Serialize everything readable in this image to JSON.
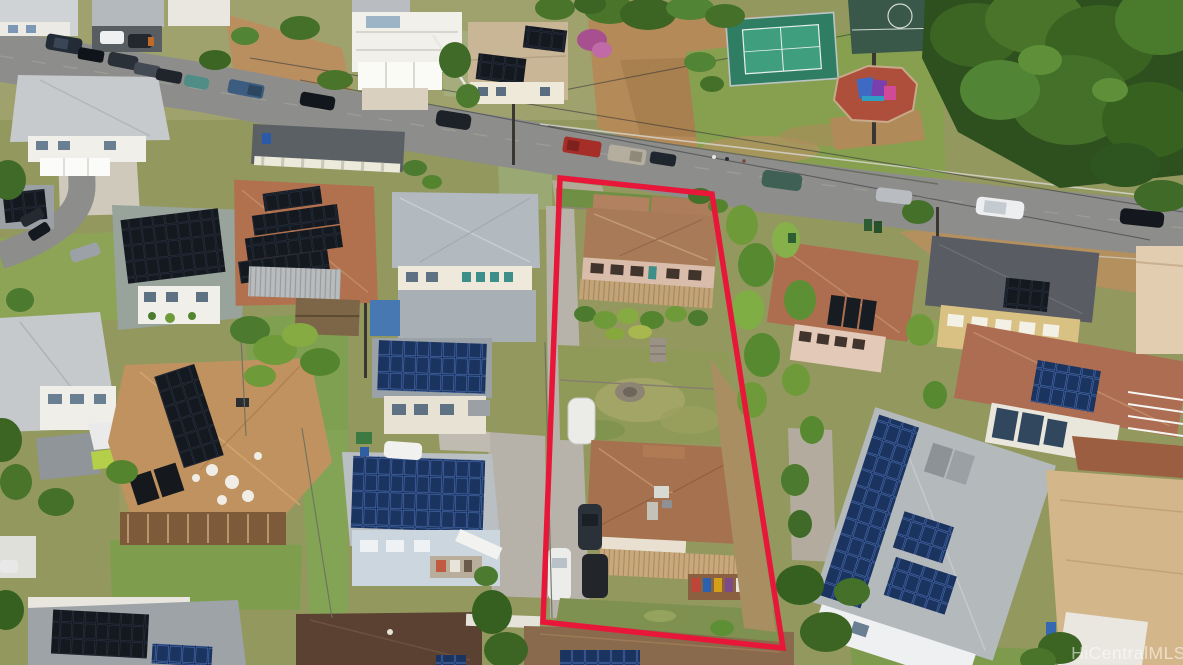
{
  "meta": {
    "title": "Aerial drone photograph of a residential hillside neighborhood",
    "style": "top-down oblique aerial real-estate photo, daytime, sunny",
    "region_hint": "tropical suburb with many rooftop solar installations"
  },
  "watermark": {
    "text": "HiCentralMLS",
    "color": "#ffffff",
    "opacity": "0.55"
  },
  "property_outline": {
    "description": "red boundary drawn around the deep flag-shaped subject lot in the center",
    "color": "#e8173a",
    "stroke_width": "5.5",
    "points": "560,178 712,194 783,648 543,622"
  },
  "subject_lot": {
    "front_house": "two-story tan house with brown hip roof, corrugated awning and tropical garden",
    "rear_house": "single-story house with brown hip roof and long carport awning",
    "yard": "patchy green lawn with rock terracing and stone mound",
    "driveway": "concrete strip along the left boundary",
    "vehicles": [
      "covered white vehicle",
      "white sedan",
      "dark sedan",
      "dark sedan"
    ]
  },
  "park": {
    "features": [
      "fenced tennis court",
      "basketball court",
      "playground with red surface",
      "grass field",
      "walking path with pedestrians"
    ],
    "tennis_court_color": "#3f9e7d",
    "basketball_court_color": "#39584a",
    "playground_surface_color": "#ad4f3a"
  },
  "roads": {
    "main_road": "two-lane street running diagonally from upper-left to the right edge, lined with parked cars",
    "side_street": "narrow lane curving down the left edge of the frame",
    "surface_color": "#8d8d8b"
  },
  "parked_vehicles_main_road": [
    "dark SUV",
    "black sedan",
    "dark SUV",
    "gray sedan",
    "dark sedan",
    "teal hatchback",
    "blue pickup",
    "black sedan",
    "dark minivan",
    "red pickup",
    "tan pickup",
    "dark sedan",
    "teal SUV",
    "silver sedan",
    "white SUV",
    "dark SUV"
  ],
  "houses": [
    {
      "id": "front-house-in-lot",
      "roof": "brown hip",
      "solar": "none"
    },
    {
      "id": "rear-house-in-lot",
      "roof": "brown hip with carport",
      "solar": "none"
    },
    {
      "id": "stepped-solar-house-left",
      "roof": "red-brown shingle",
      "solar": "four stepped rows of dark panels"
    },
    {
      "id": "big-tan-house-left",
      "roof": "tan shingle",
      "solar": "long double ridge strip + 2 thermal panels"
    },
    {
      "id": "blue-walled-house-center",
      "roof": "gray",
      "solar": "large blue array"
    },
    {
      "id": "gray-roof-house-center",
      "roof": "light gray hip",
      "solar": "blue array on lower wing"
    },
    {
      "id": "big-solar-house-right",
      "roof": "gray",
      "solar": "long strip plus two clusters and thermal panels"
    },
    {
      "id": "yellow-house-right",
      "roof": "dark gray",
      "solar": "two panels"
    },
    {
      "id": "red-roof-house-right",
      "roof": "red-brown",
      "solar": "three thermal panels"
    },
    {
      "id": "bottom-left-house",
      "roof": "gray",
      "solar": "black array + blue array"
    },
    {
      "id": "bottom-center-house",
      "roof": "dark brown",
      "solar": "one blue panel"
    },
    {
      "id": "bottom-tan-house",
      "roof": "light brown",
      "solar": "blue array"
    }
  ],
  "palette": {
    "grass": "#7fa050",
    "dry_grass": "#a7a86a",
    "dirt": "#b48a58",
    "road": "#8d8d8b",
    "tree_dark": "#2e4f1e",
    "tree_mid": "#44702a",
    "tree_light": "#6f9a3a",
    "solar_blue": "#1b335f",
    "solar_black": "#14181f",
    "roof_brown": "#a5714e",
    "roof_gray": "#b2bac0"
  }
}
